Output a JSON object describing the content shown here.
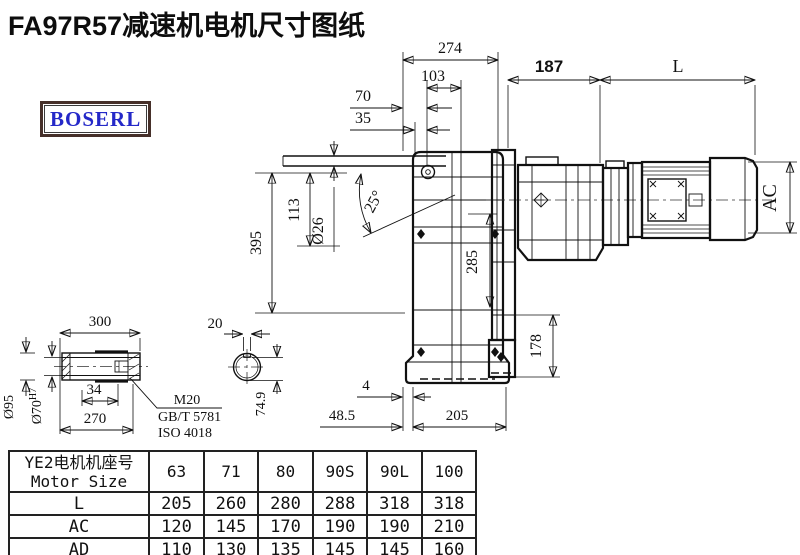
{
  "title": "FA97R57减速机电机尺寸图纸",
  "logo": "BOSERL",
  "dims": {
    "d274": "274",
    "d103": "103",
    "d70": "70",
    "d35": "35",
    "d395": "395",
    "d113": "113",
    "dia26": "Ø26",
    "angle25": "25°",
    "d285": "285",
    "d178": "178",
    "d4": "4",
    "d48_5": "48.5",
    "d205": "205",
    "d187": "187",
    "dL": "L",
    "dAC": "AC",
    "d300": "300",
    "d34": "34",
    "d270": "270",
    "dia95": "Ø95",
    "dia70": "Ø70",
    "dia70_tol": "H7",
    "m20": "M20",
    "gbt5781": "GB/T 5781",
    "iso4018": "ISO 4018",
    "d20": "20",
    "d74_9": "74.9"
  },
  "table": {
    "header_cn": "YE2电机机座号",
    "header_en": "Motor Size",
    "sizes": [
      "63",
      "71",
      "80",
      "90S",
      "90L",
      "100"
    ],
    "rows": [
      {
        "label": "L",
        "values": [
          "205",
          "260",
          "280",
          "288",
          "318",
          "318"
        ]
      },
      {
        "label": "AC",
        "values": [
          "120",
          "145",
          "170",
          "190",
          "190",
          "210"
        ]
      },
      {
        "label": "AD",
        "values": [
          "110",
          "130",
          "135",
          "145",
          "145",
          "160"
        ]
      }
    ]
  }
}
